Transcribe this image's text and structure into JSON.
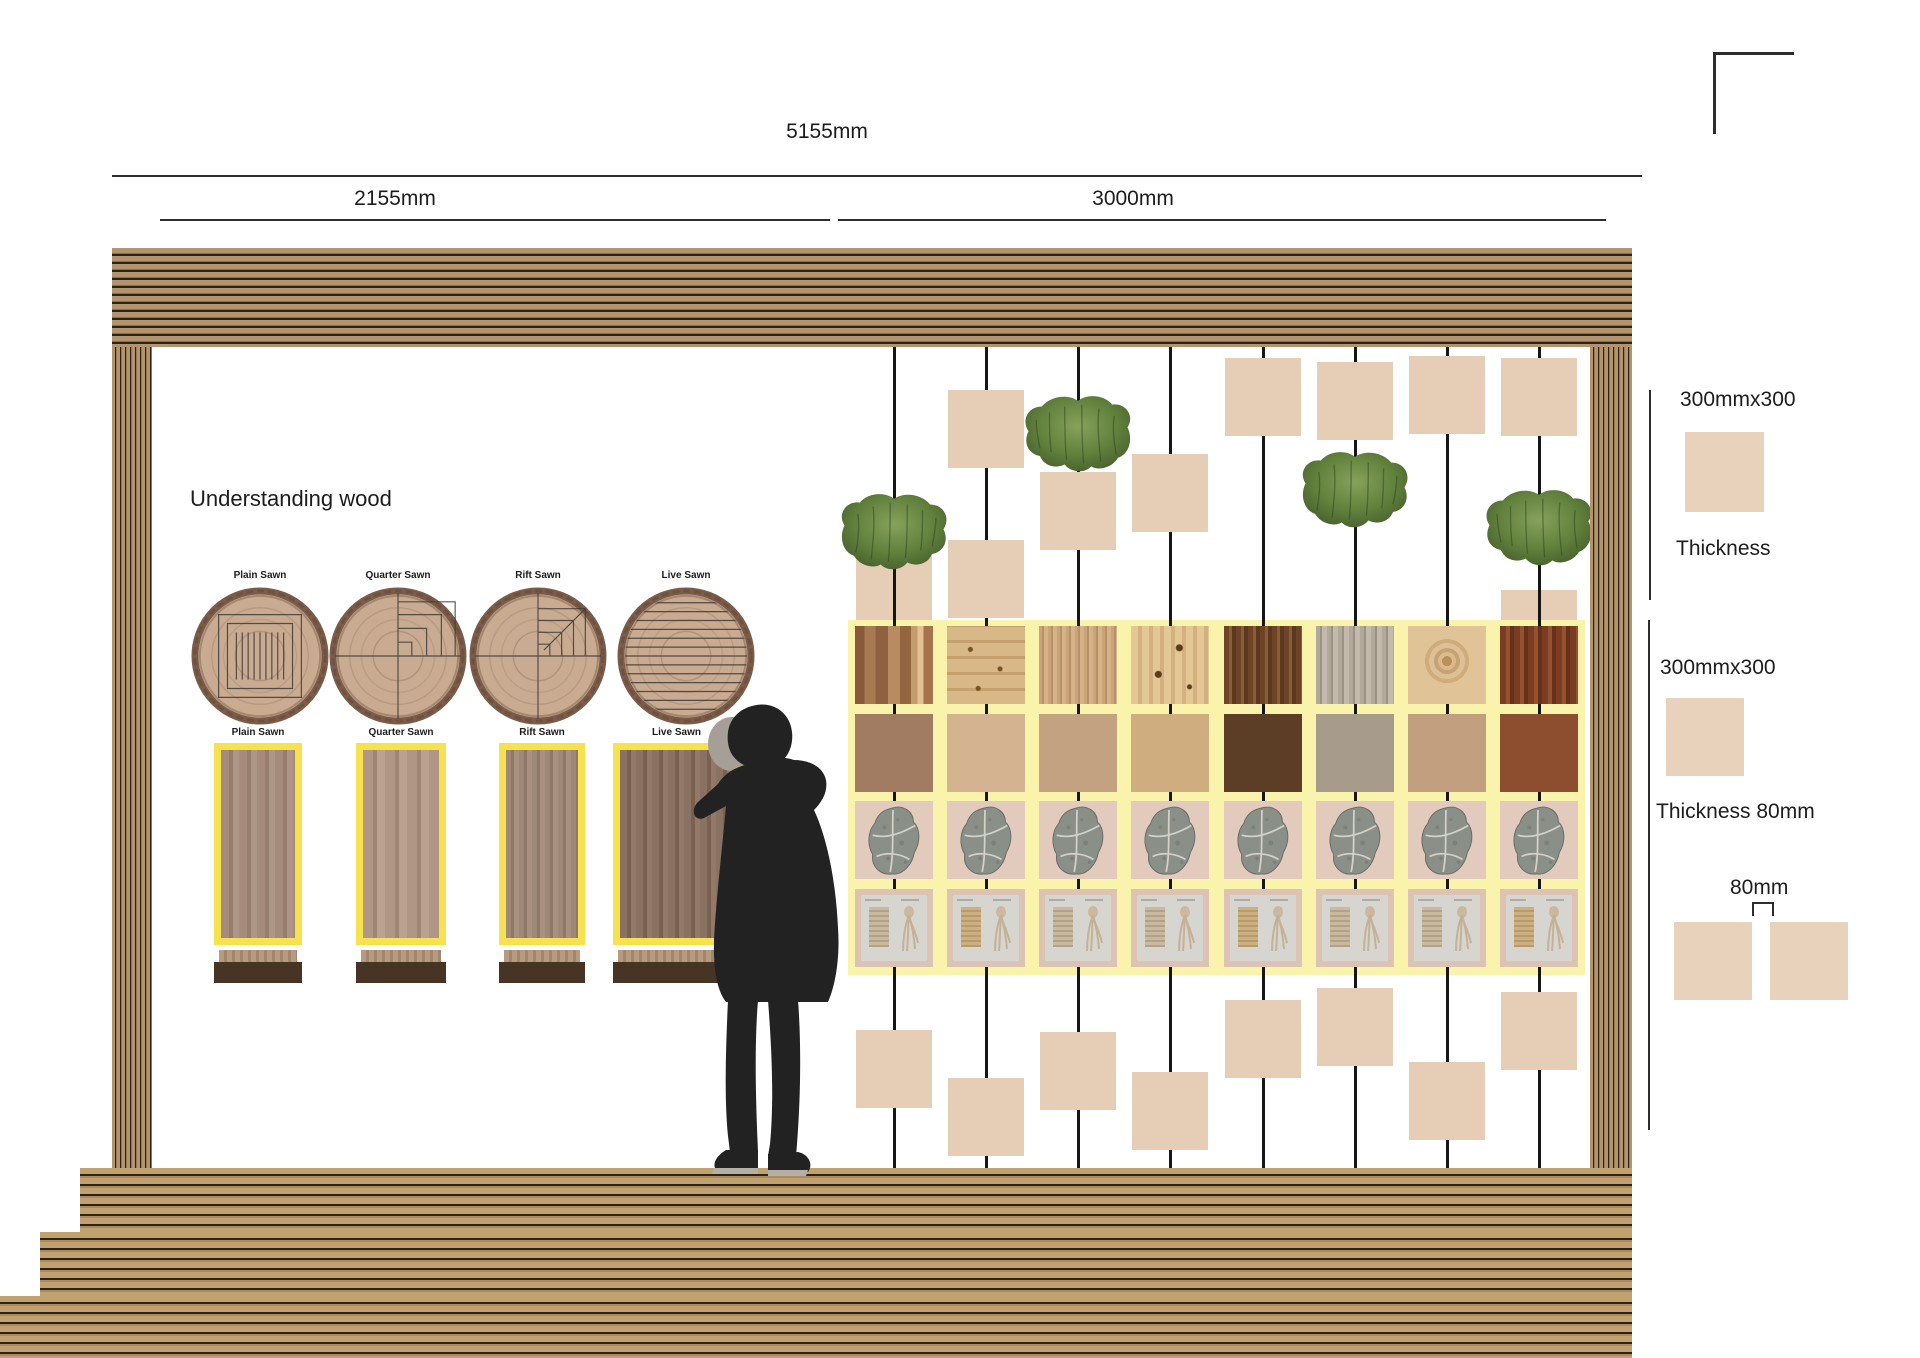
{
  "scene": {
    "width": 1920,
    "height": 1358,
    "type": "exhibition-wall-elevation"
  },
  "dimensions": {
    "total": "5155mm",
    "left": "2155mm",
    "right": "3000mm"
  },
  "section_title": "Understanding wood",
  "sawn_labels": [
    "Plain Sawn",
    "Quarter Sawn",
    "Rift Sawn",
    "Live Sawn"
  ],
  "right_panel": {
    "top": {
      "size": "300mmx300",
      "thickness": "Thickness"
    },
    "bottom": {
      "size": "300mmx300",
      "thickness": "Thickness 80mm",
      "gap": "80mm"
    }
  },
  "grid": {
    "cols": 8,
    "rows": [
      "wood-texture-sample",
      "solid-color-sample",
      "stone-leaf-imprint",
      "fabric-sample-card"
    ],
    "row1_textures": [
      "walnut",
      "knotty-pine",
      "cedar-straight-grain",
      "knotty-spruce",
      "dark-walnut",
      "weathered-gray",
      "pale-pine-knot",
      "mahogany"
    ],
    "row2_colors": [
      "#a27c62",
      "#d4b490",
      "#c3a281",
      "#d0ad7e",
      "#5c3e26",
      "#a79c8b",
      "#c2a07f",
      "#8c4e2e"
    ]
  },
  "colors": {
    "grid_panel_yellow": "#faf3ac",
    "plank_border_yellow": "#f6e24e",
    "hanging_square": "#e6cdb6",
    "swatch_beige": "#e8d2bc",
    "stone_tile_beige": "#e2cbbc",
    "card_frame_beige": "#dcc3b3",
    "wood_stripe_tan": "#b2946f",
    "wood_stripe_dark": "#2b2218",
    "moss_green": "#60803c",
    "fossil_gray": "#8a8f88",
    "figure_black": "#222222",
    "phone_yellow": "#e3c133",
    "stand_bar_brown": "#463424"
  },
  "counts": {
    "wires": 8,
    "hanging_squares_above": 8,
    "hanging_squares_tucked": 2,
    "hanging_squares_below": 8,
    "moss_clusters": 4
  }
}
